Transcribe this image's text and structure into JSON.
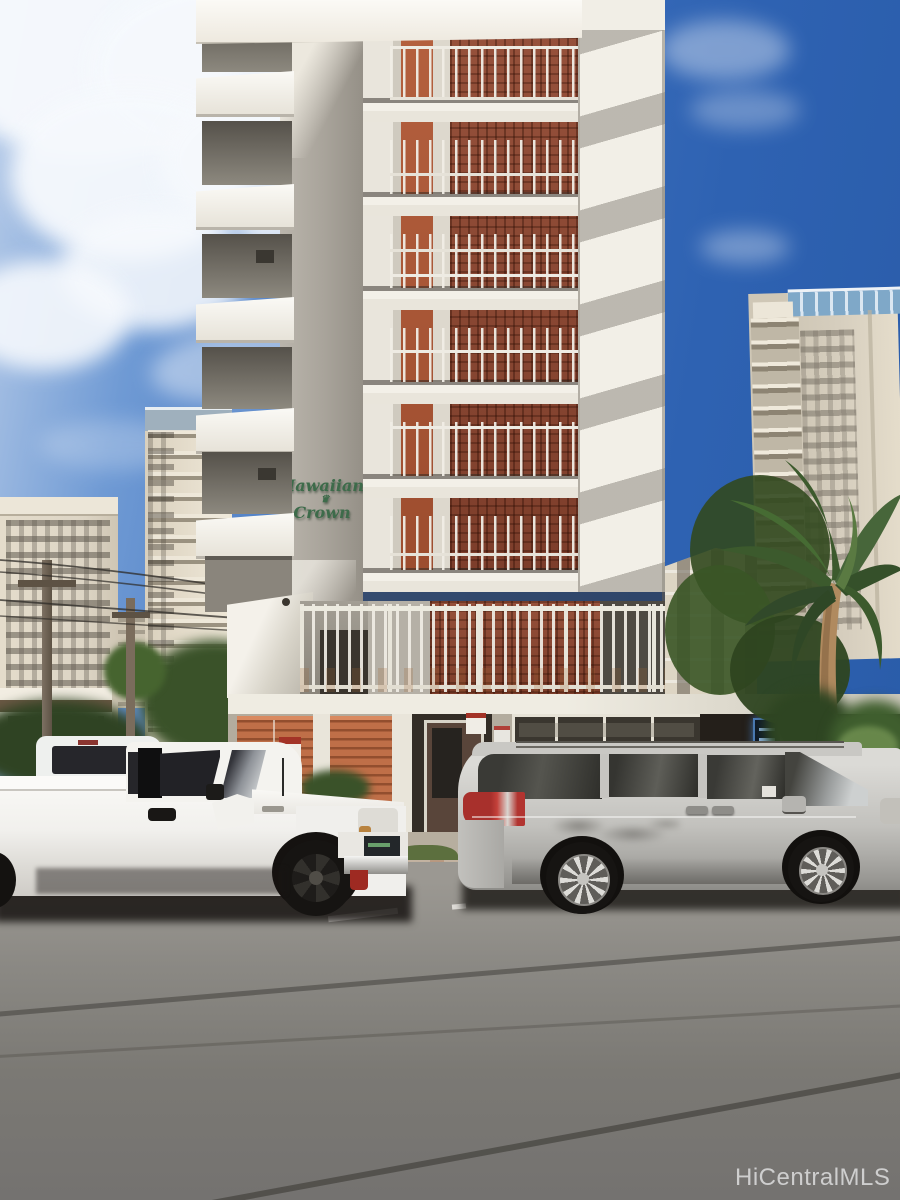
{
  "meta": {
    "type": "photograph",
    "scene": "Street-level exterior photo of the Hawaiian Crown condominium building on a sunny day, white pickup truck and silver minivan parked at the curb, Waikiki high-rises and palm trees in the background"
  },
  "building": {
    "name": "Hawaiian Crown",
    "sign_line1": "Hawaiian",
    "crown_glyph": "♛",
    "sign_line2": "Crown"
  },
  "watermark": {
    "text": "HiCentralMLS"
  },
  "vehicles": [
    {
      "name": "white-pickup-truck"
    },
    {
      "name": "silver-minivan"
    },
    {
      "name": "white-truck-behind"
    }
  ],
  "colors": {
    "sky_deep": "#2a5ca9",
    "sky_light": "#b9cde9",
    "cloud_white": "#f6f9fd",
    "facade_white": "#efebe2",
    "facade_shadow": "#b2ada4",
    "column_gray": "#a8a39a",
    "screen_rust": "#8c4a36",
    "door_orange": "#b4603e",
    "louver_orange": "#bf6f48",
    "railing_white": "#ebe8e0",
    "sign_green": "#3d6b4a",
    "bg_building_beige": "#ddd5c5",
    "tower_cap_blue": "#9fb0bd",
    "rooftop_glass_blue": "#7fa8c8",
    "palm_green": "#46642f",
    "fence_orange": "#b25834",
    "street_gray": "#8e8c88",
    "curb_tan": "#bda995",
    "grass_green": "#5c6f3e",
    "truck_white": "#f4f3f0",
    "van_silver": "#c6c5c1",
    "glass_dark": "#2b2b28",
    "taillight_red": "#b23430",
    "store_sign_blue": "#0d1828",
    "watermark_gray": "#dbdbdb"
  }
}
